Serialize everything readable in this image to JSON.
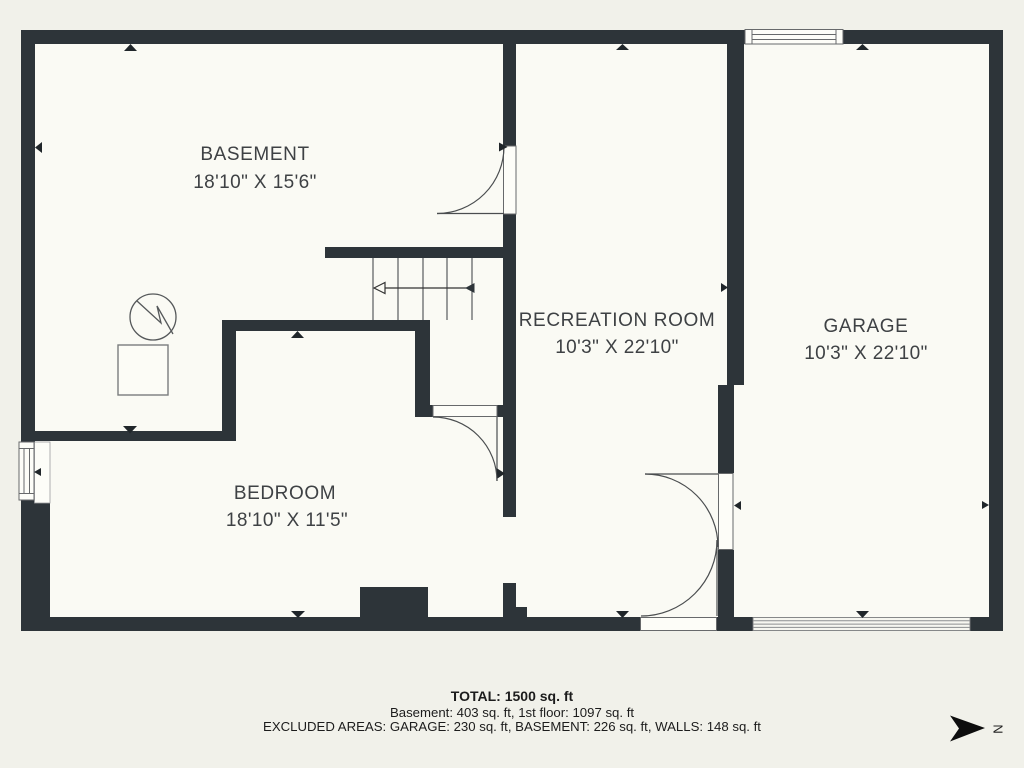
{
  "floor_plan": {
    "rooms": [
      {
        "name": "BASEMENT",
        "dimensions": "18'10\" X 15'6\""
      },
      {
        "name": "RECREATION ROOM",
        "dimensions": "10'3\" X 22'10\""
      },
      {
        "name": "GARAGE",
        "dimensions": "10'3\" X 22'10\""
      },
      {
        "name": "BEDROOM",
        "dimensions": "18'10\" X 11'5\""
      }
    ],
    "compass": {
      "label": "N"
    },
    "icons": {
      "electrical_panel": "circle-with-lightning-bolt",
      "utility_box": "square-outline",
      "stairs": "treads-with-direction-arrow",
      "doors": "quarter-circle-swing",
      "garage_door": "hatched-band",
      "north_arrow": "solid-right-arrow"
    },
    "colors": {
      "wall": "#2d3439",
      "background": "#f1f1ea",
      "floor": "#fafaf4",
      "line": "#4a4d4f",
      "label_text": "#3e4144",
      "footer_text": "#1c1c1c"
    }
  },
  "footer": {
    "total": "TOTAL: 1500 sq. ft",
    "floors": "Basement: 403 sq. ft, 1st floor: 1097 sq. ft",
    "excluded": "EXCLUDED AREAS: GARAGE: 230 sq. ft, BASEMENT: 226 sq. ft, WALLS: 148 sq. ft"
  }
}
